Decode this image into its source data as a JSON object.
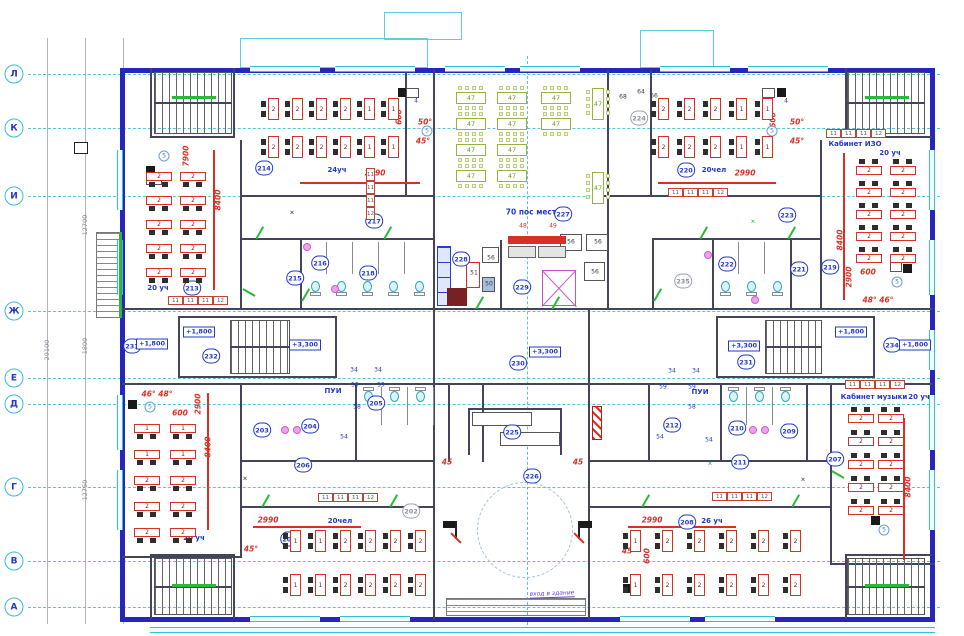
{
  "axis": {
    "letters": [
      "Л",
      "К",
      "И",
      "Ж",
      "Е",
      "Д",
      "Г",
      "В",
      "А"
    ],
    "y": [
      74,
      128,
      196,
      311,
      378,
      404,
      487,
      561,
      607
    ]
  },
  "dims": [
    {
      "t": "29100",
      "x": 47,
      "y": 350
    },
    {
      "t": "12700",
      "x": 85,
      "y": 225
    },
    {
      "t": "1800",
      "x": 85,
      "y": 346
    },
    {
      "t": "12750",
      "x": 85,
      "y": 490
    },
    {
      "t": "3030",
      "x": 123,
      "y": 100
    },
    {
      "t": "3660",
      "x": 123,
      "y": 162
    },
    {
      "t": "6890",
      "x": 123,
      "y": 253
    },
    {
      "t": "1690",
      "x": 123,
      "y": 391
    },
    {
      "t": "4200",
      "x": 123,
      "y": 445
    },
    {
      "t": "3860",
      "x": 123,
      "y": 524
    },
    {
      "t": "3030",
      "x": 123,
      "y": 590
    }
  ],
  "rooms": [
    {
      "n": "201",
      "x": 289,
      "y": 539
    },
    {
      "n": "202",
      "x": 411,
      "y": 511,
      "m": 1
    },
    {
      "n": "203",
      "x": 262,
      "y": 430
    },
    {
      "n": "204",
      "x": 310,
      "y": 426
    },
    {
      "n": "205",
      "x": 376,
      "y": 403
    },
    {
      "n": "206",
      "x": 303,
      "y": 465
    },
    {
      "n": "207",
      "x": 835,
      "y": 459
    },
    {
      "n": "208",
      "x": 687,
      "y": 522
    },
    {
      "n": "209",
      "x": 789,
      "y": 431
    },
    {
      "n": "210",
      "x": 737,
      "y": 428
    },
    {
      "n": "211",
      "x": 740,
      "y": 462
    },
    {
      "n": "212",
      "x": 672,
      "y": 425
    },
    {
      "n": "213",
      "x": 192,
      "y": 288
    },
    {
      "n": "214",
      "x": 264,
      "y": 168
    },
    {
      "n": "215",
      "x": 295,
      "y": 278
    },
    {
      "n": "216",
      "x": 320,
      "y": 263
    },
    {
      "n": "217",
      "x": 374,
      "y": 221
    },
    {
      "n": "218",
      "x": 368,
      "y": 273
    },
    {
      "n": "219",
      "x": 830,
      "y": 267
    },
    {
      "n": "220",
      "x": 686,
      "y": 170
    },
    {
      "n": "221",
      "x": 799,
      "y": 269
    },
    {
      "n": "222",
      "x": 727,
      "y": 264
    },
    {
      "n": "223",
      "x": 787,
      "y": 215
    },
    {
      "n": "224",
      "x": 639,
      "y": 118,
      "m": 1
    },
    {
      "n": "225",
      "x": 512,
      "y": 432
    },
    {
      "n": "226",
      "x": 532,
      "y": 476
    },
    {
      "n": "227",
      "x": 563,
      "y": 214
    },
    {
      "n": "228",
      "x": 461,
      "y": 259
    },
    {
      "n": "229",
      "x": 522,
      "y": 287
    },
    {
      "n": "230",
      "x": 518,
      "y": 363
    },
    {
      "n": "231",
      "x": 746,
      "y": 362
    },
    {
      "n": "232",
      "x": 211,
      "y": 356
    },
    {
      "n": "233",
      "x": 132,
      "y": 346
    },
    {
      "n": "234",
      "x": 892,
      "y": 345
    },
    {
      "n": "235",
      "x": 683,
      "y": 281,
      "m": 1
    }
  ],
  "labels": [
    {
      "t": "20 уч",
      "x": 158,
      "y": 288
    },
    {
      "t": "24уч",
      "x": 337,
      "y": 170
    },
    {
      "t": "20чел",
      "x": 714,
      "y": 170
    },
    {
      "t": "Кабинет ИЗО",
      "x": 855,
      "y": 144
    },
    {
      "t": "20 уч",
      "x": 890,
      "y": 153
    },
    {
      "t": "70 пос мест",
      "x": 531,
      "y": 212,
      "big": 1
    },
    {
      "t": "ПУИ",
      "x": 333,
      "y": 391
    },
    {
      "t": "ПУИ",
      "x": 700,
      "y": 392
    },
    {
      "t": "Кабинет музыки",
      "x": 874,
      "y": 397
    },
    {
      "t": "20 уч",
      "x": 919,
      "y": 397
    },
    {
      "t": "20 уч",
      "x": 194,
      "y": 538
    },
    {
      "t": "20чел",
      "x": 340,
      "y": 521
    },
    {
      "t": "26 уч",
      "x": 712,
      "y": 521
    }
  ],
  "elevations": [
    {
      "t": "+1,800",
      "x": 152,
      "y": 344
    },
    {
      "t": "+1,800",
      "x": 199,
      "y": 332
    },
    {
      "t": "+3,300",
      "x": 305,
      "y": 345
    },
    {
      "t": "+3,300",
      "x": 545,
      "y": 352
    },
    {
      "t": "+3,300",
      "x": 744,
      "y": 346
    },
    {
      "t": "+1,800",
      "x": 851,
      "y": 332
    },
    {
      "t": "+1,800",
      "x": 915,
      "y": 345
    }
  ],
  "red_dims": [
    {
      "t": "7900",
      "x": 186,
      "y": 156,
      "r": 1
    },
    {
      "t": "8400",
      "x": 218,
      "y": 200,
      "r": 1
    },
    {
      "t": "600",
      "x": 399,
      "y": 117,
      "r": 1
    },
    {
      "t": "50°",
      "x": 425,
      "y": 122
    },
    {
      "t": "45°",
      "x": 423,
      "y": 141
    },
    {
      "t": "2990",
      "x": 375,
      "y": 173
    },
    {
      "t": "600",
      "x": 773,
      "y": 120,
      "r": 1
    },
    {
      "t": "50°",
      "x": 797,
      "y": 122
    },
    {
      "t": "45°",
      "x": 797,
      "y": 141
    },
    {
      "t": "2990",
      "x": 745,
      "y": 173
    },
    {
      "t": "8400",
      "x": 840,
      "y": 240,
      "r": 1
    },
    {
      "t": "2900",
      "x": 849,
      "y": 277,
      "r": 1
    },
    {
      "t": "600",
      "x": 868,
      "y": 272
    },
    {
      "t": "48° 46°",
      "x": 878,
      "y": 300
    },
    {
      "t": "46° 48°",
      "x": 157,
      "y": 394
    },
    {
      "t": "600",
      "x": 180,
      "y": 413
    },
    {
      "t": "2900",
      "x": 198,
      "y": 404,
      "r": 1
    },
    {
      "t": "8400",
      "x": 208,
      "y": 447,
      "r": 1
    },
    {
      "t": "2990",
      "x": 268,
      "y": 520
    },
    {
      "t": "45°",
      "x": 251,
      "y": 549
    },
    {
      "t": "2990",
      "x": 652,
      "y": 520
    },
    {
      "t": "45°",
      "x": 629,
      "y": 551
    },
    {
      "t": "600",
      "x": 647,
      "y": 556,
      "r": 1
    },
    {
      "t": "8400",
      "x": 908,
      "y": 487,
      "r": 1
    },
    {
      "t": "45",
      "x": 447,
      "y": 462
    },
    {
      "t": "45",
      "x": 578,
      "y": 462
    }
  ],
  "tags": [
    {
      "t": "56",
      "x": 491,
      "y": 258
    },
    {
      "t": "56",
      "x": 571,
      "y": 242
    },
    {
      "t": "56",
      "x": 598,
      "y": 242
    },
    {
      "t": "56",
      "x": 595,
      "y": 272
    },
    {
      "t": "48",
      "x": 523,
      "y": 226,
      "c": "r"
    },
    {
      "t": "49",
      "x": 553,
      "y": 226,
      "c": "r"
    },
    {
      "t": "64",
      "x": 641,
      "y": 92
    },
    {
      "t": "66",
      "x": 654,
      "y": 96
    },
    {
      "t": "68",
      "x": 623,
      "y": 97
    },
    {
      "t": "51",
      "x": 474,
      "y": 273
    },
    {
      "t": "50",
      "x": 489,
      "y": 284
    },
    {
      "t": "53",
      "x": 453,
      "y": 297
    },
    {
      "t": "34",
      "x": 672,
      "y": 371,
      "c": "b"
    },
    {
      "t": "34",
      "x": 696,
      "y": 371,
      "c": "b"
    },
    {
      "t": "34",
      "x": 354,
      "y": 370,
      "c": "b"
    },
    {
      "t": "34",
      "x": 378,
      "y": 370,
      "c": "b"
    },
    {
      "t": "59",
      "x": 355,
      "y": 385,
      "c": "b"
    },
    {
      "t": "59",
      "x": 381,
      "y": 385,
      "c": "b"
    },
    {
      "t": "59",
      "x": 663,
      "y": 387,
      "c": "b"
    },
    {
      "t": "59",
      "x": 692,
      "y": 387,
      "c": "b"
    },
    {
      "t": "58",
      "x": 692,
      "y": 407,
      "c": "b"
    },
    {
      "t": "58",
      "x": 357,
      "y": 407,
      "c": "b"
    },
    {
      "t": "54",
      "x": 660,
      "y": 437,
      "c": "b"
    },
    {
      "t": "54",
      "x": 709,
      "y": 440,
      "c": "b"
    },
    {
      "t": "54",
      "x": 344,
      "y": 437,
      "c": "b"
    },
    {
      "t": "4",
      "x": 416,
      "y": 101,
      "c": "b"
    },
    {
      "t": "4",
      "x": 786,
      "y": 101,
      "c": "b"
    },
    {
      "t": "✕",
      "x": 292,
      "y": 213
    },
    {
      "t": "✕",
      "x": 245,
      "y": 479
    },
    {
      "t": "✕",
      "x": 803,
      "y": 480
    },
    {
      "t": "✕",
      "x": 753,
      "y": 222,
      "c": "g"
    },
    {
      "t": "✕",
      "x": 710,
      "y": 464,
      "c": "g"
    }
  ],
  "circled": {
    "t": "5",
    "pos": [
      [
        164,
        156
      ],
      [
        427,
        131
      ],
      [
        772,
        131
      ],
      [
        897,
        282
      ],
      [
        150,
        407
      ],
      [
        884,
        530
      ]
    ]
  },
  "strip_labels": [
    "11",
    "11",
    "11",
    "12"
  ],
  "strips": [
    {
      "x": 168,
      "y": 296
    },
    {
      "x": 366,
      "y": 168,
      "v": 1
    },
    {
      "x": 668,
      "y": 188
    },
    {
      "x": 826,
      "y": 129
    },
    {
      "x": 845,
      "y": 380
    },
    {
      "x": 318,
      "y": 493
    },
    {
      "x": 712,
      "y": 492
    }
  ],
  "desk_default": "2",
  "classrooms": [
    {
      "id": "213",
      "x": 146,
      "y": 172,
      "cols": 2,
      "rows": 5,
      "dx": 34,
      "dy": 24,
      "type": "v",
      "ch": "b"
    },
    {
      "id": "214",
      "x": 268,
      "y": 98,
      "cols": 6,
      "rows": 2,
      "dx": 24,
      "dy": 38,
      "type": "h",
      "col_labels": [
        "2",
        "2",
        "2",
        "2",
        "1",
        "1"
      ]
    },
    {
      "id": "220",
      "x": 658,
      "y": 98,
      "cols": 5,
      "rows": 2,
      "dx": 26,
      "dy": 38,
      "type": "h",
      "col_labels": [
        "2",
        "2",
        "2",
        "1",
        "1"
      ]
    },
    {
      "id": "219",
      "x": 856,
      "y": 166,
      "cols": 2,
      "rows": 5,
      "dx": 34,
      "dy": 22,
      "type": "v",
      "ch": "a"
    },
    {
      "id": "201",
      "x": 134,
      "y": 424,
      "cols": 2,
      "rows": 5,
      "dx": 36,
      "dy": 26,
      "type": "v",
      "ch": "b",
      "row_labels": [
        "1",
        "1",
        "2",
        "2",
        "2"
      ]
    },
    {
      "id": "207",
      "x": 848,
      "y": 414,
      "cols": 2,
      "rows": 5,
      "dx": 30,
      "dy": 23,
      "type": "v",
      "ch": "a"
    },
    {
      "id": "202",
      "x": 290,
      "y": 530,
      "cols": 6,
      "rows": 2,
      "dx": 25,
      "dy": 44,
      "type": "h",
      "col_labels": [
        "1",
        "1",
        "2",
        "2",
        "2",
        "2"
      ]
    },
    {
      "id": "208",
      "x": 630,
      "y": 530,
      "cols": 6,
      "rows": 2,
      "dx": 32,
      "dy": 44,
      "type": "h",
      "col_labels": [
        "1",
        "2",
        "2",
        "2",
        "2",
        "2"
      ]
    }
  ],
  "dining": {
    "label": "47",
    "h_tables": [
      [
        456,
        92
      ],
      [
        497,
        92
      ],
      [
        541,
        92
      ],
      [
        456,
        118
      ],
      [
        497,
        118
      ],
      [
        541,
        118
      ],
      [
        456,
        144
      ],
      [
        497,
        144
      ],
      [
        456,
        170
      ],
      [
        497,
        170
      ]
    ],
    "v_tables": [
      [
        592,
        88
      ],
      [
        592,
        172
      ]
    ]
  },
  "note": {
    "t": "вход в здание",
    "x": 552,
    "y": 594
  }
}
